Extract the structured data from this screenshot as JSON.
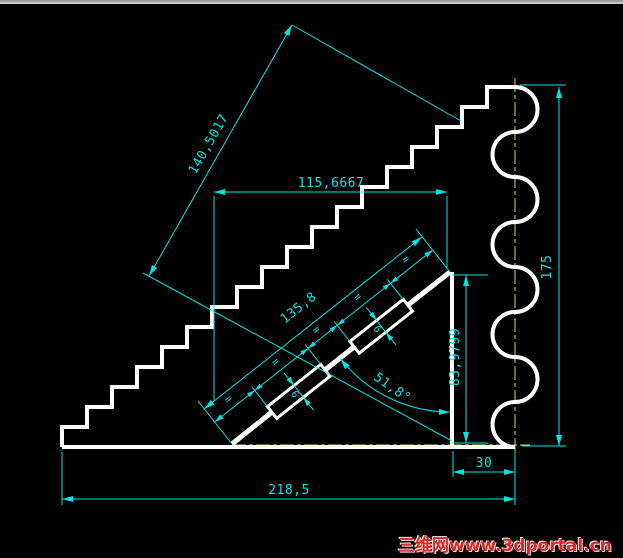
{
  "canvas": {
    "background": "#000000",
    "line_color": "#ffffff",
    "dim_color": "#00e6e6",
    "centerline_color": "#d6d66a"
  },
  "dims": {
    "aligned_total": "140,5017",
    "top_width": "115,6667",
    "incline_length": "135,8",
    "right_height": "175",
    "inner_height": "83,9799",
    "angle": "51,8°",
    "right_offset": "30",
    "base_width": "218,5",
    "plate_width_upper": "6",
    "plate_width_lower": "6",
    "equal_marks": [
      "=",
      "=",
      "=",
      "=",
      "="
    ]
  },
  "watermark": {
    "text": "三维网www.3dportal.cn",
    "color": "#d42a2a"
  }
}
